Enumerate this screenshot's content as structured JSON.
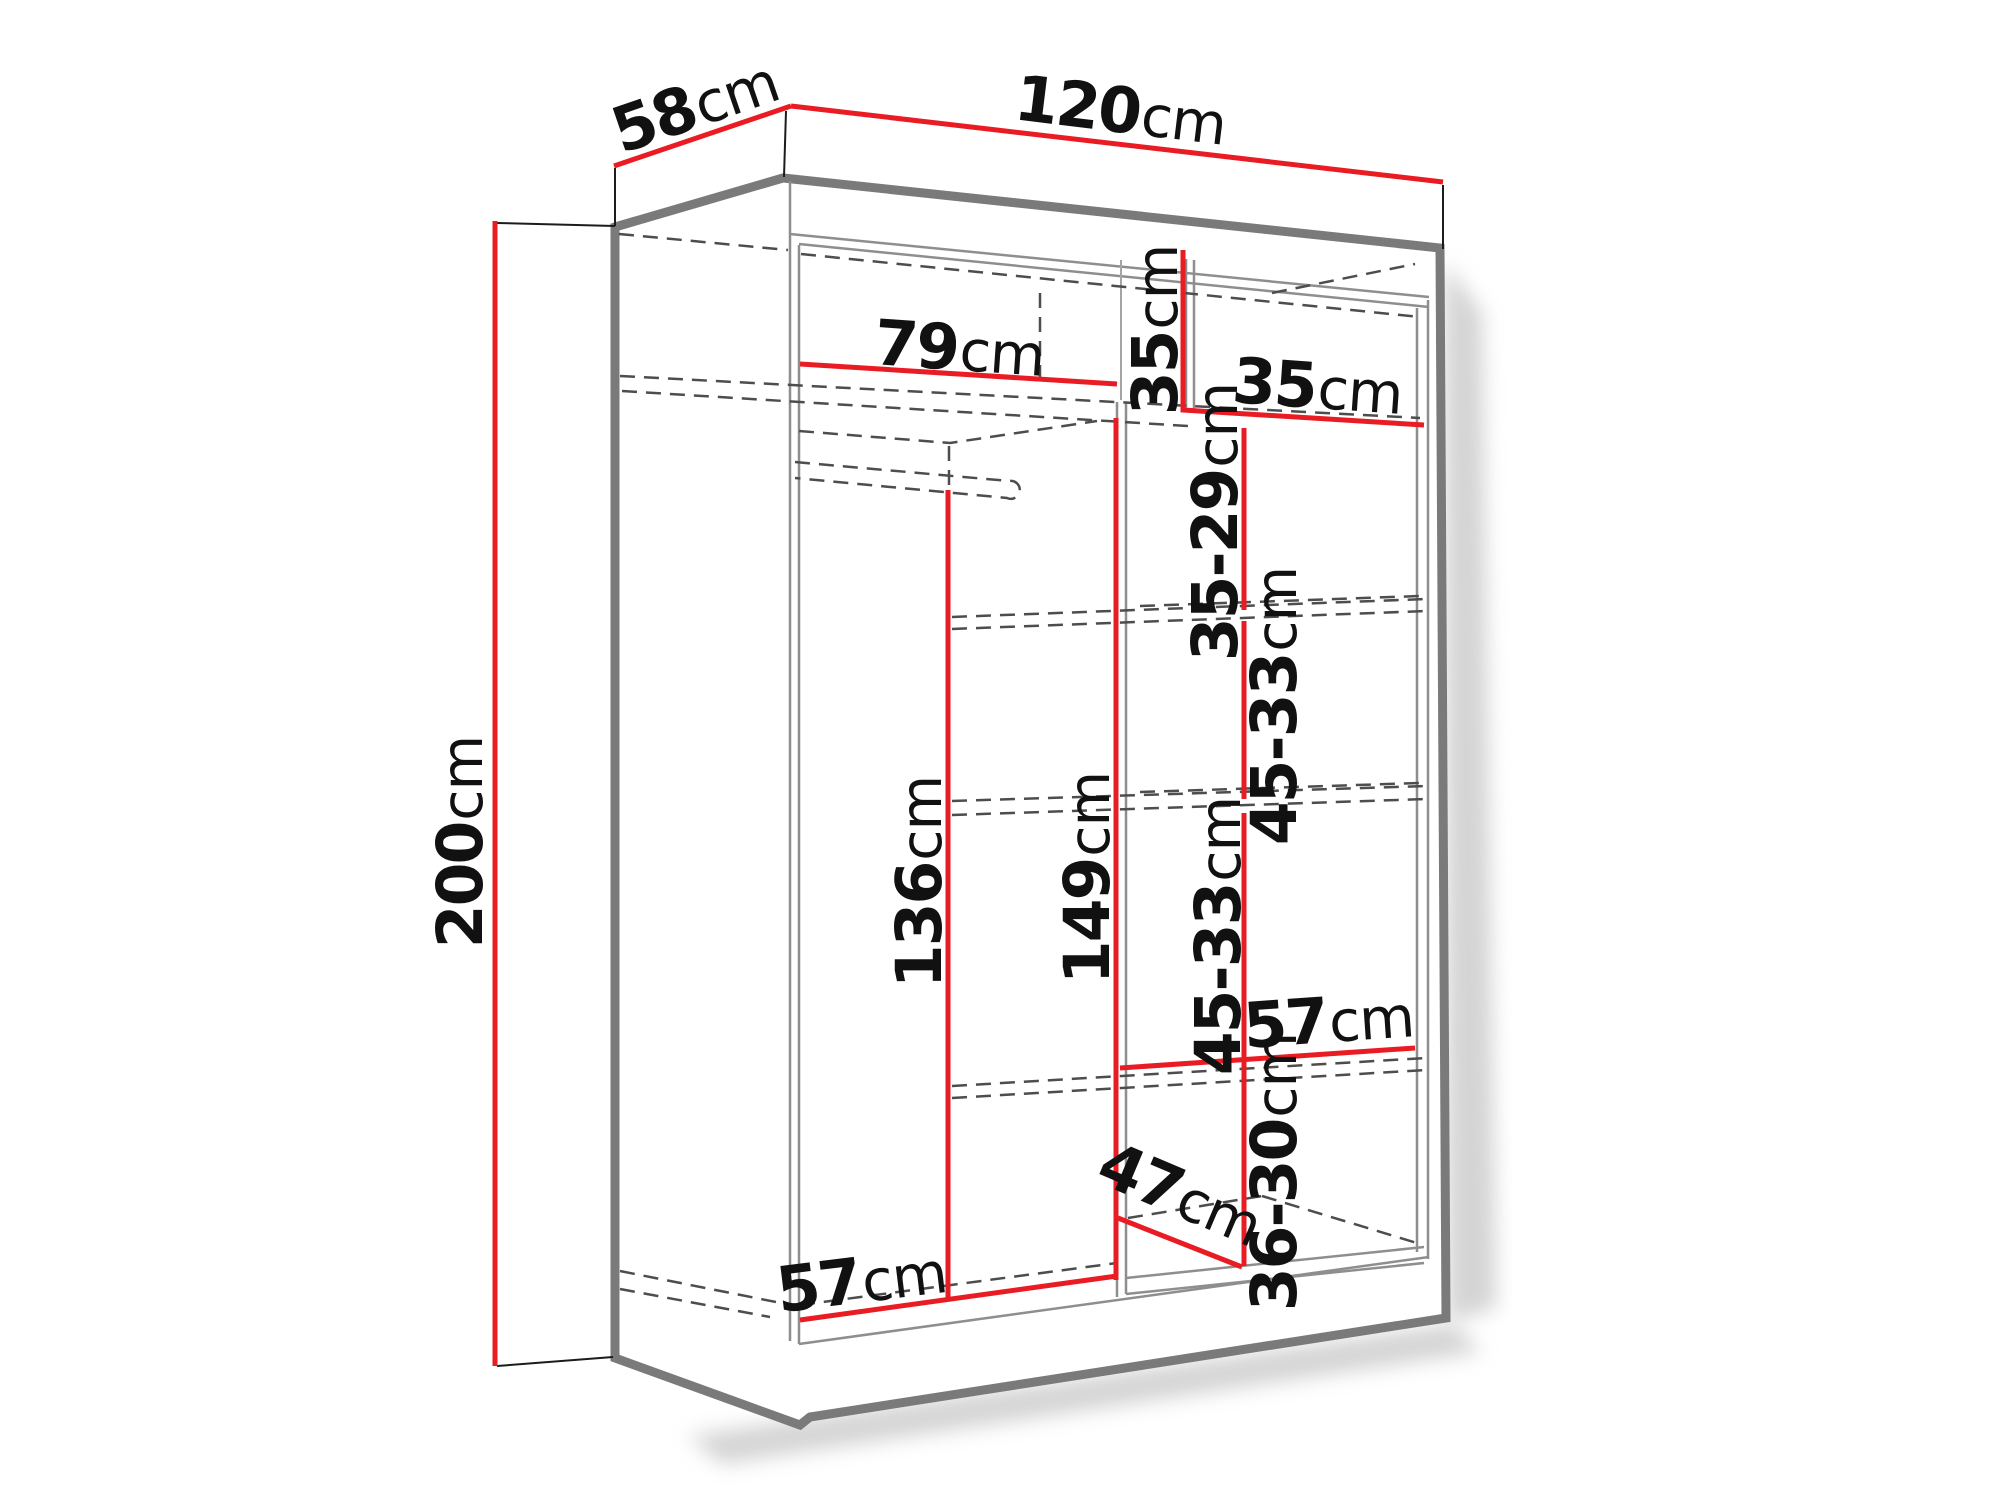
{
  "diagram": {
    "type": "furniture-dimension-drawing",
    "subject": "sliding-door wardrobe interior dimensions",
    "unit": "cm",
    "dimension_labels": {
      "depth": {
        "value": "58",
        "unit": "cm"
      },
      "width": {
        "value": "120",
        "unit": "cm"
      },
      "height": {
        "value": "200",
        "unit": "cm"
      },
      "top_shelf_width": {
        "value": "79",
        "unit": "cm"
      },
      "top_cubby_height": {
        "value": "35",
        "unit": "cm"
      },
      "top_cubby_width": {
        "value": "35",
        "unit": "cm"
      },
      "shelf_gap_1": {
        "value": "35-29",
        "unit": "cm"
      },
      "shelf_gap_2": {
        "value": "45-33",
        "unit": "cm"
      },
      "shelf_gap_3": {
        "value": "45-33",
        "unit": "cm"
      },
      "shelf_gap_4": {
        "value": "36-30",
        "unit": "cm"
      },
      "hanging_height": {
        "value": "136",
        "unit": "cm"
      },
      "divider_height": {
        "value": "149",
        "unit": "cm"
      },
      "shelf_width": {
        "value": "57",
        "unit": "cm"
      },
      "bottom_depth": {
        "value": "47",
        "unit": "cm"
      },
      "bottom_left_width": {
        "value": "57",
        "unit": "cm"
      }
    },
    "colors": {
      "dimension": "#ea1c23",
      "outline": "#7a7a7a",
      "interior": "#8e8e8e",
      "hidden": "#4d4d4d",
      "extension": "#1c1c1c",
      "text": "#111111",
      "background": "#ffffff"
    }
  }
}
